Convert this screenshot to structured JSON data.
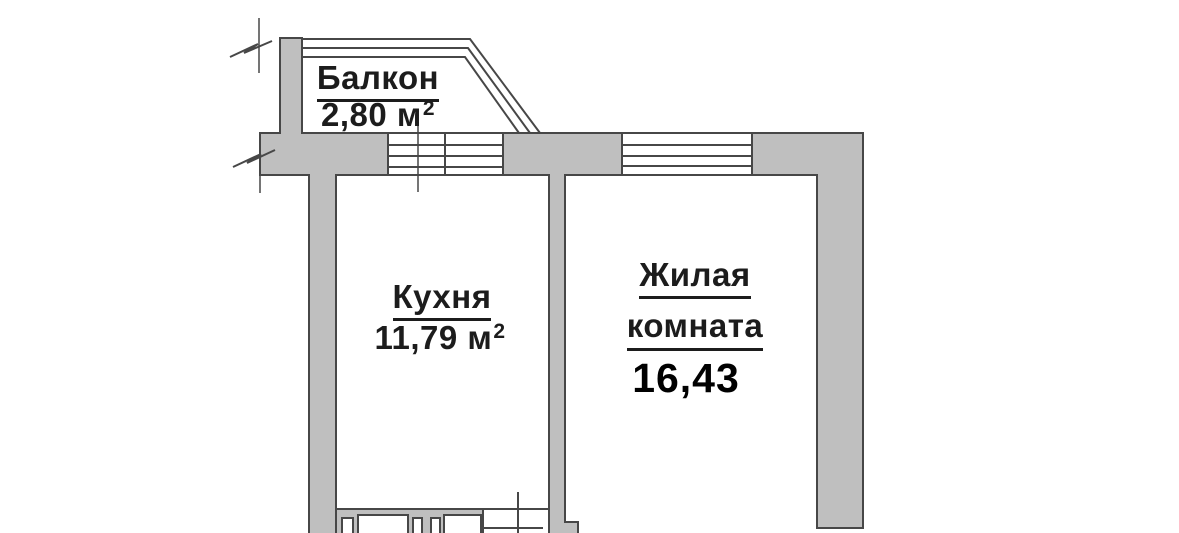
{
  "colors": {
    "background": "#ffffff",
    "wall_fill": "#bfbfbf",
    "line": "#474747",
    "text": "#1c1c1c"
  },
  "rooms": {
    "balcony": {
      "name": "Балкон",
      "area_value": "2,80",
      "area_unit": "м",
      "area_superscript": "2"
    },
    "kitchen": {
      "name": "Кухня",
      "area_value": "11,79",
      "area_unit": "м",
      "area_superscript": "2"
    },
    "living_room": {
      "name_line1": "Жилая",
      "name_line2": "комната",
      "area_value": "16,43"
    }
  }
}
